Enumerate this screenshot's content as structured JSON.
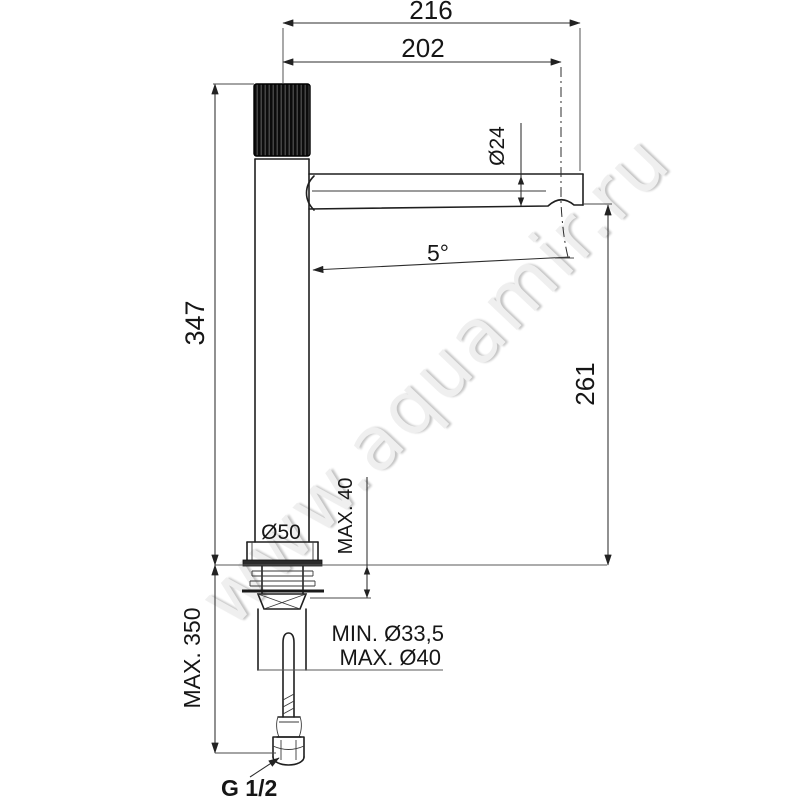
{
  "watermark": {
    "text": "www.aquamir.ru",
    "color": "#efefef"
  },
  "drawing": {
    "line_color": "#1f1f1f",
    "background": "#ffffff",
    "dimensions": {
      "spout_total": "216",
      "spout_reach": "202",
      "spout_diameter": "Ø24",
      "spout_angle": "5°",
      "height_total": "347",
      "height_outlet": "261",
      "base_diameter": "Ø50",
      "deck_max_thickness": "MAX. 40",
      "below_deck_max": "MAX. 350",
      "hole_min_diameter": "MIN. Ø33,5",
      "hole_max_diameter": "MAX. Ø40",
      "connection_thread": "G 1/2"
    }
  }
}
